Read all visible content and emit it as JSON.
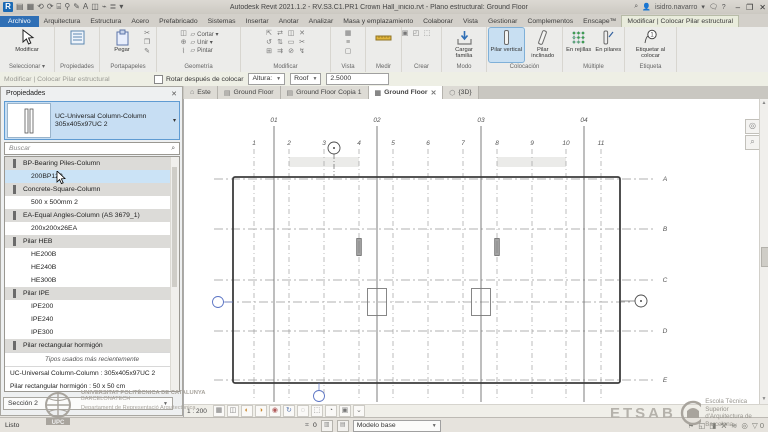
{
  "app": {
    "title": "Autodesk Revit 2021.1.2 - RV.S3.C1.PR1 Crown Hall_inicio.rvt - Plano estructural: Ground Floor",
    "user": "isidro.navarro",
    "window_controls": [
      "–",
      "❐",
      "✕"
    ],
    "qat_glyphs": [
      "▤",
      "▦",
      "⟲",
      "⟳",
      "⌸",
      "⚲",
      "✎",
      "A",
      "◫",
      "⌁",
      "≣",
      "▾"
    ]
  },
  "ribbon": {
    "tabs": [
      {
        "label": "Archivo",
        "style": "file"
      },
      {
        "label": "Arquitectura"
      },
      {
        "label": "Estructura"
      },
      {
        "label": "Acero"
      },
      {
        "label": "Prefabricado"
      },
      {
        "label": "Sistemas"
      },
      {
        "label": "Insertar"
      },
      {
        "label": "Anotar"
      },
      {
        "label": "Analizar"
      },
      {
        "label": "Masa y emplazamiento"
      },
      {
        "label": "Colaborar"
      },
      {
        "label": "Vista"
      },
      {
        "label": "Gestionar"
      },
      {
        "label": "Complementos"
      },
      {
        "label": "Enscape™"
      },
      {
        "label": "Modificar | Colocar Pilar estructural",
        "style": "ctx"
      }
    ],
    "panels": [
      {
        "label": "Seleccionar ▾",
        "w": 55,
        "items": [
          {
            "t": "big",
            "icon": "cursor",
            "label": "Modificar"
          }
        ]
      },
      {
        "label": "Propiedades",
        "w": 45,
        "items": [
          {
            "t": "big",
            "icon": "properties",
            "label": ""
          }
        ]
      },
      {
        "label": "Portapapeles",
        "w": 57,
        "items": [
          {
            "t": "big",
            "icon": "paste",
            "label": "Pegar"
          },
          {
            "t": "small",
            "glyphs": [
              "✂",
              "❐",
              "✎"
            ]
          }
        ]
      },
      {
        "label": "Geometría",
        "w": 84,
        "items": [
          {
            "t": "small",
            "glyphs": [
              "◫",
              "⊕",
              "⌇"
            ]
          },
          {
            "t": "rows",
            "rows": [
              "Cortar ▾",
              "Unir ▾",
              "Pintar"
            ]
          }
        ]
      },
      {
        "label": "Modificar",
        "w": 90,
        "items": [
          {
            "t": "grid",
            "glyphs": [
              "⇱",
              "⇄",
              "◫",
              "✕",
              "↺",
              "⇅",
              "▭",
              "✂",
              "⊞",
              "⇉",
              "⊘",
              "↯"
            ]
          }
        ]
      },
      {
        "label": "Vista",
        "w": 35,
        "items": [
          {
            "t": "small",
            "glyphs": [
              "▦",
              "≡",
              "▢"
            ]
          }
        ]
      },
      {
        "label": "Medir",
        "w": 36,
        "items": [
          {
            "t": "big",
            "icon": "measure",
            "label": ""
          }
        ]
      },
      {
        "label": "Crear",
        "w": 40,
        "items": [
          {
            "t": "grid",
            "glyphs": [
              "▣",
              "◰",
              "⬚"
            ]
          }
        ]
      },
      {
        "label": "Modo",
        "w": 45,
        "items": [
          {
            "t": "big",
            "icon": "load",
            "label": "Cargar familia"
          }
        ]
      },
      {
        "label": "Colocación",
        "w": 76,
        "items": [
          {
            "t": "big",
            "icon": "col-v",
            "label": "Pilar vertical",
            "active": true
          },
          {
            "t": "big",
            "icon": "col-i",
            "label": "Pilar inclinado"
          }
        ]
      },
      {
        "label": "Múltiple",
        "w": 62,
        "items": [
          {
            "t": "big",
            "icon": "grids",
            "label": "En rejillas"
          },
          {
            "t": "big",
            "icon": "cols",
            "label": "En pilares"
          }
        ]
      },
      {
        "label": "Etiqueta",
        "w": 52,
        "items": [
          {
            "t": "big",
            "icon": "tag",
            "label": "Etiquetar al colocar"
          }
        ]
      }
    ]
  },
  "options_bar": {
    "mode_label": "Modificar | Colocar Pilar estructural",
    "rotate_checkbox": "Rotar después de colocar",
    "height_mode": "Altura:",
    "height_level": "Roof",
    "height_value": "2.5000"
  },
  "view_tabs": [
    {
      "label": "Este",
      "icon": "⌂"
    },
    {
      "label": "Ground Floor",
      "icon": "▤"
    },
    {
      "label": "Ground Floor Copia 1",
      "icon": "▤"
    },
    {
      "label": "Ground Floor",
      "icon": "▦",
      "active": true,
      "close": "✕"
    },
    {
      "label": "{3D}",
      "icon": "⬡"
    }
  ],
  "properties": {
    "header": "Propiedades",
    "close": "✕",
    "type_selector": {
      "line1": "UC-Universal Column-Column",
      "line2": "305x405x97UC 2"
    },
    "search_placeholder": "Buscar",
    "list": [
      {
        "kind": "family",
        "label": "BP-Bearing Piles-Column"
      },
      {
        "kind": "type",
        "label": "200BP122",
        "hover": true
      },
      {
        "kind": "family",
        "label": "Concrete-Square-Column"
      },
      {
        "kind": "type",
        "label": "500 x 500mm 2"
      },
      {
        "kind": "family",
        "label": "EA-Equal Angles-Column (AS 3679_1)"
      },
      {
        "kind": "type",
        "label": "200x200x26EA"
      },
      {
        "kind": "family",
        "label": "Pilar HEB"
      },
      {
        "kind": "type",
        "label": "HE200B"
      },
      {
        "kind": "type",
        "label": "HE240B"
      },
      {
        "kind": "type",
        "label": "HE300B"
      },
      {
        "kind": "family",
        "label": "Pilar IPE"
      },
      {
        "kind": "type",
        "label": "IPE200"
      },
      {
        "kind": "type",
        "label": "IPE240"
      },
      {
        "kind": "type",
        "label": "IPE300"
      },
      {
        "kind": "family",
        "label": "Pilar rectangular hormigón"
      },
      {
        "kind": "sep",
        "label": "Tipos usados más recientemente"
      },
      {
        "kind": "recent",
        "label": "UC-Universal Column-Column : 305x405x97UC 2"
      },
      {
        "kind": "recent",
        "label": "Pilar rectangular hormigón : 50 x 50 cm"
      }
    ],
    "bottom_combo": "Sección 2"
  },
  "plan": {
    "scale_label": "1 : 200",
    "minor_grids": {
      "labels": [
        "1",
        "2",
        "3",
        "4",
        "5",
        "6",
        "7",
        "8",
        "9",
        "10",
        "11"
      ],
      "xs": [
        70,
        105,
        140,
        175,
        209,
        244,
        279,
        313,
        348,
        382,
        417
      ]
    },
    "major_grids": {
      "labels": [
        "01",
        "02",
        "03",
        "04"
      ],
      "xs": [
        90,
        193,
        297,
        400
      ]
    },
    "row_grids": {
      "labels": [
        "A",
        "B",
        "C",
        "D",
        "E"
      ],
      "ys": [
        80,
        130,
        181,
        232,
        281
      ]
    },
    "mid_line_y": 203,
    "building": {
      "x": 49,
      "y": 78,
      "w": 387,
      "h": 206
    },
    "bands": [
      {
        "x": 105,
        "y": 58,
        "w": 70,
        "h": 10
      },
      {
        "x": 313,
        "y": 58,
        "w": 69,
        "h": 10
      }
    ],
    "steel_columns": [
      {
        "x": 175,
        "y": 148
      },
      {
        "x": 313,
        "y": 148
      }
    ],
    "concrete_columns": [
      {
        "x": 193,
        "y": 203
      },
      {
        "x": 297,
        "y": 203
      }
    ],
    "markers": {
      "top": {
        "x": 150,
        "y": 49
      },
      "bottom": {
        "x": 135,
        "y": 297
      },
      "left": {
        "x": 34,
        "y": 203
      },
      "right": {
        "x": 457,
        "y": 202
      }
    }
  },
  "view_controls": {
    "icons": [
      "▦",
      "◫",
      "◐",
      "◑",
      "◉",
      "↻",
      "◌",
      "⬚",
      "◔",
      "▣",
      "⌄"
    ]
  },
  "status_bar": {
    "ready": "Listo",
    "counter": "0",
    "design_option": "Modelo base",
    "filter_glyph": "▽",
    "filter_count": "0",
    "right_glyphs": [
      "⚑",
      "◱",
      "◨",
      "⚒",
      "≋",
      "◎"
    ]
  },
  "watermarks": {
    "upc_line1": "UNIVERSITAT POLITÈCNICA DE CATALUNYA",
    "upc_line2": "BARCELONATECH",
    "upc_line3": "Departament de Representació Arquitectònica",
    "upc_logo": "UPC",
    "etsab": "ETSAB",
    "school_line1": "Escola Tècnica Superior",
    "school_line2": "d'Arquitectura de Barcelona"
  }
}
